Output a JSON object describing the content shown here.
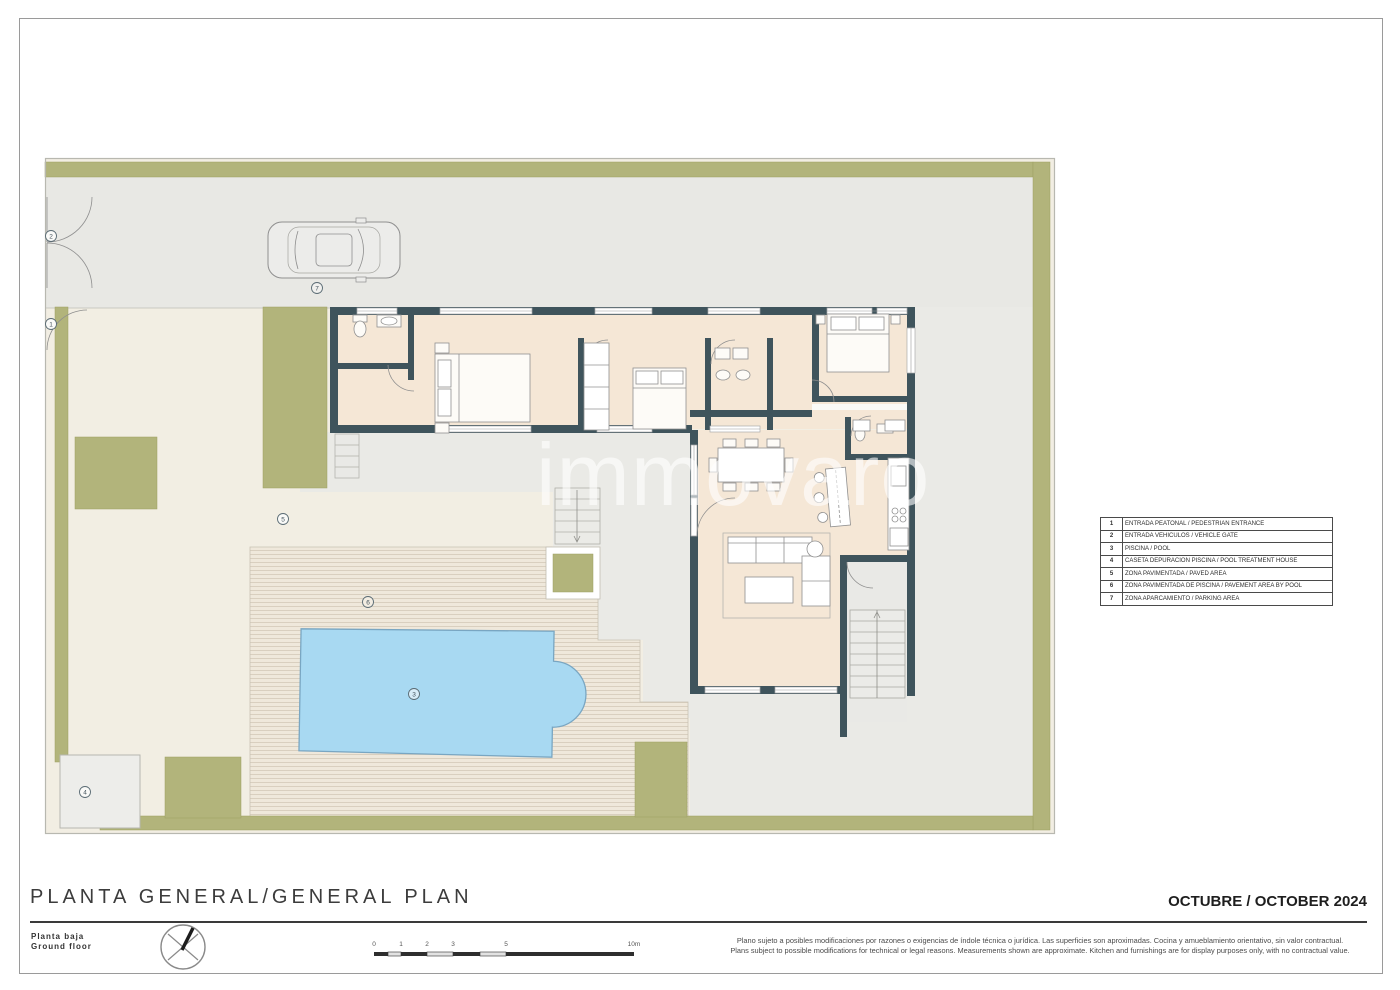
{
  "page": {
    "title": "PLANTA GENERAL/GENERAL PLAN",
    "subtitle_es": "Planta baja",
    "subtitle_en": "Ground floor",
    "date": "OCTUBRE / OCTOBER 2024",
    "watermark": "immovaro",
    "disclaimer_es": "Plano sujeto a posibles modificaciones por razones o exigencias de índole técnica o jurídica. Las superficies son aproximadas. Cocina y amueblamiento orientativo, sin valor contractual.",
    "disclaimer_en": "Plans subject to possible modifications for technical or legal reasons. Measurements shown are approximate. Kitchen and furnishings are for display purposes only, with no contractual value."
  },
  "legend": {
    "rows": [
      {
        "num": "1",
        "label": "ENTRADA PEATONAL / PEDESTRIAN ENTRANCE"
      },
      {
        "num": "2",
        "label": "ENTRADA VEHICULOS / VEHICLE GATE"
      },
      {
        "num": "3",
        "label": "PISCINA / POOL"
      },
      {
        "num": "4",
        "label": "CASETA DEPURACION PISCINA / POOL TREATMENT HOUSE"
      },
      {
        "num": "5",
        "label": "ZONA PAVIMENTADA / PAVED AREA"
      },
      {
        "num": "6",
        "label": "ZONA PAVIMENTADA DE PISCINA / PAVEMENT AREA BY POOL"
      },
      {
        "num": "7",
        "label": "ZONA APARCAMIENTO / PARKING AREA"
      }
    ]
  },
  "scalebar": {
    "labels": [
      "0",
      "1",
      "2",
      "3",
      "5",
      "10m"
    ]
  },
  "colors": {
    "wall": "#3f545c",
    "interior": "#f5e7d6",
    "olive": "#b2b47b",
    "cream_paving": "#f2eee3",
    "gray_paving": "#e9e9e5",
    "pool_fill": "#a8d9f2",
    "pool_edge": "#79a6c2"
  }
}
